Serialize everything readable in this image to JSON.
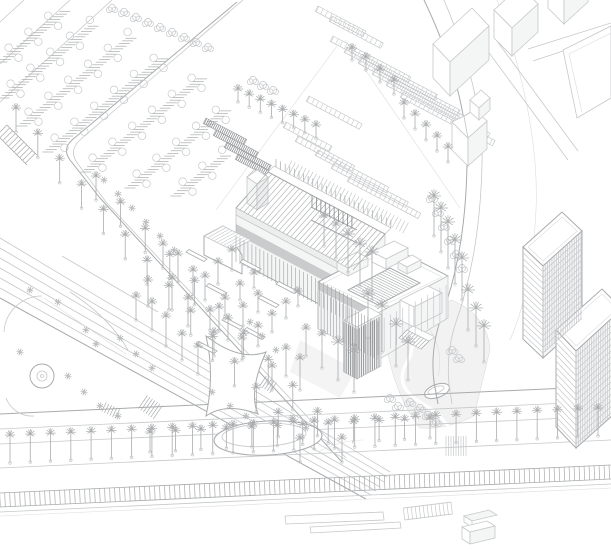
{
  "scene": {
    "type": "axonometric-architectural-site-plan",
    "background": "#ffffff"
  },
  "palette": {
    "background": "#ffffff",
    "line_faint": "#dbdcdd",
    "line_light": "#c6c8ca",
    "line_mid": "#a9abad",
    "line_dark": "#8f9193",
    "fill_white": "#ffffff",
    "fill_pale": "#f4f5f5",
    "fill_shade": "#eceded",
    "fill_dark_band": "#a6a8aa"
  },
  "palm_rows": [
    [
      16,
      132,
      300,
      462,
      14,
      24
    ],
    [
      96,
      200,
      342,
      462,
      11,
      24
    ],
    [
      10,
      463,
      598,
      436,
      30,
      28
    ],
    [
      150,
      452,
      430,
      438,
      12,
      20
    ],
    [
      238,
      102,
      316,
      138,
      8,
      13
    ],
    [
      404,
      118,
      448,
      162,
      5,
      15
    ]
  ],
  "palm_field": [
    [
      163,
      268,
      24
    ],
    [
      178,
      282,
      28
    ],
    [
      193,
      296,
      26
    ],
    [
      172,
      310,
      32
    ],
    [
      188,
      326,
      28
    ],
    [
      205,
      300,
      24
    ],
    [
      218,
      284,
      22
    ],
    [
      232,
      270,
      20
    ],
    [
      152,
      330,
      28
    ],
    [
      166,
      346,
      30
    ],
    [
      182,
      360,
      26
    ],
    [
      198,
      374,
      28
    ],
    [
      214,
      356,
      24
    ],
    [
      228,
      340,
      22
    ],
    [
      243,
      326,
      20
    ],
    [
      258,
      312,
      18
    ],
    [
      240,
      300,
      16
    ],
    [
      254,
      288,
      15
    ],
    [
      225,
      316,
      18
    ],
    [
      210,
      330,
      20
    ],
    [
      148,
      306,
      26
    ],
    [
      136,
      320,
      24
    ],
    [
      242,
      360,
      22
    ],
    [
      258,
      346,
      20
    ],
    [
      272,
      332,
      18
    ],
    [
      286,
      318,
      16
    ],
    [
      298,
      306,
      15
    ],
    [
      306,
      356,
      28
    ],
    [
      322,
      368,
      34
    ],
    [
      338,
      380,
      38
    ],
    [
      354,
      392,
      42
    ],
    [
      368,
      338,
      44
    ],
    [
      382,
      352,
      46
    ],
    [
      396,
      366,
      42
    ],
    [
      408,
      380,
      38
    ],
    [
      300,
      390,
      32
    ],
    [
      286,
      376,
      28
    ],
    [
      272,
      390,
      24
    ],
    [
      372,
      300,
      48
    ],
    [
      360,
      286,
      42
    ],
    [
      348,
      272,
      38
    ],
    [
      336,
      258,
      34
    ],
    [
      324,
      246,
      30
    ],
    [
      434,
      236,
      40
    ],
    [
      441,
      252,
      44
    ],
    [
      448,
      268,
      46
    ],
    [
      455,
      284,
      44
    ],
    [
      462,
      300,
      42
    ],
    [
      468,
      330,
      40
    ],
    [
      476,
      346,
      38
    ],
    [
      484,
      362,
      36
    ],
    [
      352,
      60,
      12
    ],
    [
      366,
      70,
      13
    ],
    [
      380,
      82,
      13
    ],
    [
      394,
      94,
      14
    ]
  ],
  "star_trees": [
    [
      30,
      290
    ],
    [
      58,
      302
    ],
    [
      86,
      330
    ],
    [
      20,
      352
    ],
    [
      96,
      344
    ],
    [
      120,
      338
    ],
    [
      136,
      354
    ],
    [
      152,
      368
    ],
    [
      250,
      322
    ],
    [
      262,
      336
    ],
    [
      276,
      350
    ],
    [
      68,
      376
    ],
    [
      84,
      392
    ],
    [
      100,
      406
    ],
    [
      118,
      416
    ],
    [
      230,
      406
    ],
    [
      246,
      416
    ],
    [
      212,
      392
    ],
    [
      160,
      236
    ],
    [
      146,
      222
    ],
    [
      132,
      208
    ],
    [
      118,
      194
    ],
    [
      104,
      180
    ],
    [
      174,
      250
    ],
    [
      292,
      418
    ],
    [
      306,
      428
    ]
  ],
  "shrubs": [
    [
      253,
      80
    ],
    [
      263,
      85
    ],
    [
      273,
      90
    ],
    [
      432,
      198
    ],
    [
      438,
      212
    ],
    [
      444,
      226
    ],
    [
      450,
      240
    ],
    [
      456,
      254
    ],
    [
      462,
      268
    ],
    [
      452,
      350
    ],
    [
      459,
      358
    ],
    [
      420,
      408
    ],
    [
      428,
      415
    ],
    [
      410,
      402
    ],
    [
      436,
      422
    ],
    [
      390,
      398
    ],
    [
      398,
      406
    ],
    [
      112,
      8
    ],
    [
      124,
      12
    ],
    [
      136,
      17
    ],
    [
      148,
      22
    ],
    [
      160,
      27
    ],
    [
      172,
      32
    ],
    [
      184,
      37
    ],
    [
      196,
      42
    ],
    [
      208,
      47
    ]
  ],
  "parking_rows": [
    [
      2,
      62,
      20
    ],
    [
      4,
      98,
      28
    ],
    [
      22,
      126,
      34
    ],
    [
      48,
      152,
      36
    ],
    [
      86,
      172,
      36
    ],
    [
      130,
      188,
      30
    ],
    [
      176,
      196,
      16
    ]
  ],
  "hatch_bands": [
    {
      "x1": 0,
      "y1": 500,
      "x2": 611,
      "y2": 472,
      "hw": 7,
      "step": 5,
      "tone": "mid",
      "borders": true
    },
    {
      "x1": 2,
      "y1": 130,
      "x2": 32,
      "y2": 160,
      "hw": 7,
      "step": 4,
      "tone": "mid",
      "borders": true
    },
    {
      "x1": 446,
      "y1": 446,
      "x2": 466,
      "y2": 446,
      "hw": 10,
      "step": 2.5,
      "tone": "light",
      "borders": false
    },
    {
      "x1": 143,
      "y1": 402,
      "x2": 159,
      "y2": 413,
      "hw": 8,
      "step": 3,
      "tone": "mid",
      "borders": false
    },
    {
      "x1": 263,
      "y1": 381,
      "x2": 275,
      "y2": 389,
      "hw": 6,
      "step": 3,
      "tone": "mid",
      "borders": false
    },
    {
      "x1": 104,
      "y1": 407,
      "x2": 118,
      "y2": 414,
      "hw": 5,
      "step": 3,
      "tone": "mid",
      "borders": false
    },
    {
      "x1": 404,
      "y1": 514,
      "x2": 452,
      "y2": 508,
      "hw": 6,
      "step": 4,
      "tone": "light",
      "borders": true
    },
    {
      "x1": 289,
      "y1": 166,
      "x2": 406,
      "y2": 228,
      "hw": 6,
      "step": 4,
      "tone": "light",
      "borders": false
    }
  ],
  "garden_strips": [
    [
      318,
      6,
      54,
      0
    ],
    [
      332,
      16,
      58,
      0
    ],
    [
      333,
      36,
      88,
      0
    ],
    [
      347,
      47,
      102,
      0
    ],
    [
      361,
      58,
      112,
      0
    ],
    [
      375,
      69,
      116,
      0
    ],
    [
      389,
      80,
      114,
      0
    ],
    [
      403,
      92,
      104,
      0
    ],
    [
      309,
      96,
      60,
      0
    ],
    [
      286,
      122,
      52,
      0
    ],
    [
      298,
      136,
      64,
      0
    ],
    [
      318,
      150,
      80,
      0
    ],
    [
      334,
      163,
      84,
      0
    ],
    [
      350,
      176,
      80,
      0
    ],
    [
      206,
      118,
      46,
      1
    ],
    [
      216,
      130,
      48,
      1
    ],
    [
      227,
      142,
      50,
      1
    ],
    [
      238,
      154,
      46,
      1
    ]
  ],
  "colonnades": [
    {
      "x1": 236,
      "y1": 236,
      "x2": 353,
      "y2": 298,
      "h": 26,
      "step": 4.5,
      "tone": "mid"
    },
    {
      "x1": 276,
      "y1": 167,
      "x2": 393,
      "y2": 229,
      "h": -8,
      "step": 5.2,
      "tone": "mid"
    },
    {
      "x1": 312,
      "y1": 208,
      "x2": 356,
      "y2": 231,
      "h": -13,
      "step": 5,
      "tone": "dark"
    },
    {
      "x1": 318,
      "y1": 291,
      "x2": 378,
      "y2": 322,
      "h": 38,
      "step": 3.5,
      "tone": "mid"
    },
    {
      "x1": 378,
      "y1": 321,
      "x2": 448,
      "y2": 284,
      "h": 34,
      "step": 7,
      "tone": "light"
    },
    {
      "x1": 344,
      "y1": 322,
      "x2": 357,
      "y2": 329,
      "h": 50,
      "step": 2.5,
      "tone": "dark"
    },
    {
      "x1": 357,
      "y1": 329,
      "x2": 381,
      "y2": 316,
      "h": 50,
      "step": 2.5,
      "tone": "dark"
    },
    {
      "x1": 543,
      "y1": 266,
      "x2": 582,
      "y2": 231,
      "h": 88,
      "step": 3,
      "tone": "light"
    },
    {
      "x1": 576,
      "y1": 351,
      "x2": 611,
      "y2": 320,
      "h": 96,
      "step": 3,
      "tone": "light"
    }
  ],
  "floor_lines": [
    {
      "x1": 523,
      "y1": 247,
      "x2": 543,
      "y2": 266,
      "n": 15,
      "dy": 5.8
    },
    {
      "x1": 543,
      "y1": 266,
      "x2": 582,
      "y2": 231,
      "n": 15,
      "dy": 5.8
    },
    {
      "x1": 556,
      "y1": 330,
      "x2": 576,
      "y2": 351,
      "n": 15,
      "dy": 6.2
    },
    {
      "x1": 576,
      "y1": 351,
      "x2": 611,
      "y2": 320,
      "n": 15,
      "dy": 6.2
    }
  ],
  "roof_hatch": [
    {
      "a": [
        268,
        172
      ],
      "b": [
        385,
        234
      ],
      "c": [
        236,
        208
      ],
      "d": [
        353,
        270
      ],
      "n": 30,
      "tone": "mid"
    },
    {
      "a": [
        348,
        290
      ],
      "b": [
        390,
        268
      ],
      "c": [
        378,
        305
      ],
      "d": [
        420,
        283
      ],
      "n": 16,
      "tone": "mid"
    },
    {
      "a": [
        407,
        330
      ],
      "b": [
        429,
        341
      ],
      "c": [
        399,
        338
      ],
      "d": [
        421,
        349
      ],
      "n": 8,
      "tone": "mid"
    },
    {
      "a": [
        223,
        226
      ],
      "b": [
        251,
        240
      ],
      "c": [
        205,
        236
      ],
      "d": [
        233,
        250
      ],
      "n": 9,
      "tone": "light"
    }
  ],
  "benches": [
    [
      206,
      286
    ],
    [
      240,
      262
    ],
    [
      258,
      298
    ],
    [
      222,
      320
    ],
    [
      186,
      252
    ],
    [
      276,
      284
    ],
    [
      244,
      330
    ],
    [
      196,
      344
    ]
  ]
}
